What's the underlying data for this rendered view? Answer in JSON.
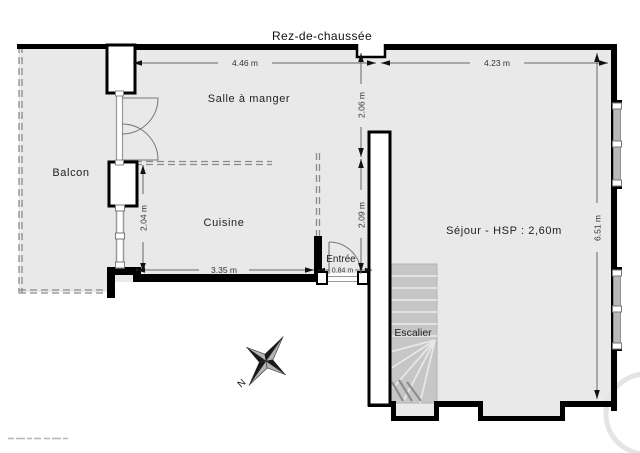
{
  "title": "Rez-de-chaussée",
  "rooms": {
    "balcon": {
      "label": "Balcon"
    },
    "salle": {
      "label": "Salle à manger"
    },
    "cuisine": {
      "label": "Cuisine"
    },
    "entree": {
      "label": "Entrée"
    },
    "sejour": {
      "label": "Séjour - HSP : 2,60m"
    },
    "escalier": {
      "label": "Escalier"
    }
  },
  "dimensions": {
    "salle_width": "4.46 m",
    "sejour_width": "4.23 m",
    "salle_height": "2.06 m",
    "entree_height": "2.09 m",
    "cuisine_height": "2.04 m",
    "cuisine_width": "3.35 m",
    "door_width": "0.84 m",
    "sejour_height": "6.51 m"
  },
  "compass": {
    "north_label": "N"
  },
  "colors": {
    "wall": "#000000",
    "floor": "#e9e9e9",
    "stairs": "#c6c6c6",
    "dashed": "#8a8a8a",
    "dimension_line": "#666666"
  }
}
